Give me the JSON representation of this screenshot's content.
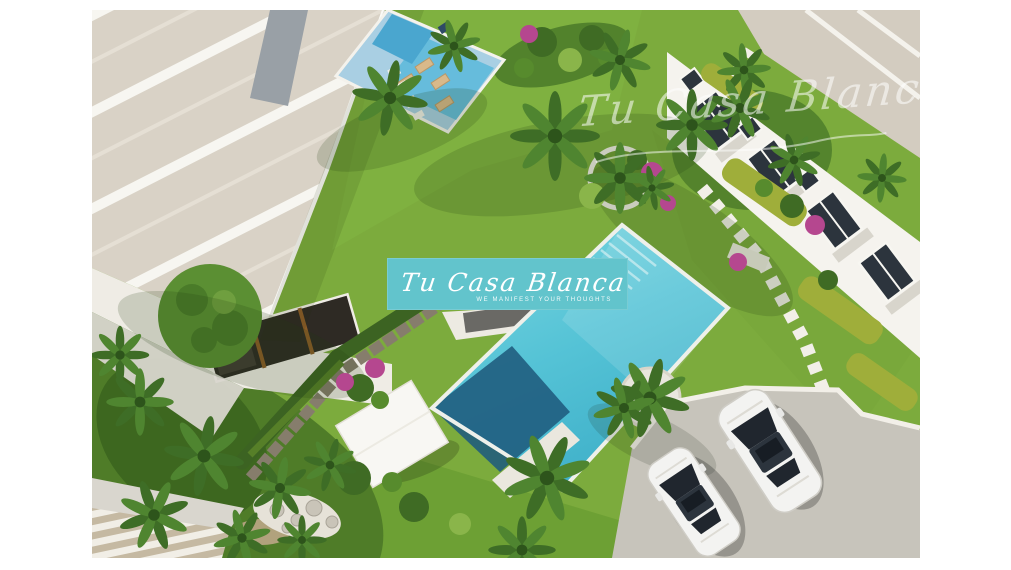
{
  "image": {
    "type": "3D architectural aerial render",
    "alt": "Aerial view of a white residential development with a large turquoise pool, a small lounge pool, landscaped palm gardens, townhouses and a parking area with two white cars"
  },
  "watermarks": {
    "center": {
      "brand": "Tu Casa Blanca",
      "tagline": "We manifest your thoughts"
    },
    "corner": {
      "brand": "Tu Casa Blanca"
    }
  },
  "colors": {
    "background": "#ffffff",
    "lawn": "#7cab3d",
    "lawn_dark": "#4f7c28",
    "pool_water": "#55c3d6",
    "pool_deep": "#1f5b7d",
    "small_pool_deck": "#a9cfe3",
    "roof_gravel": "#d9d2c6",
    "building_white": "#f5f3ee",
    "paving": "#d3ccc0",
    "parking": "#c7c4bb",
    "car_white": "#f3f3f1",
    "window_dark": "#2c343d",
    "watermark_teal": "#62c4cc",
    "flower_magenta": "#b5478f",
    "hedge_yellow_green": "#9fae3a",
    "palm_green": "#3e6d26",
    "stone_wall": "#867d6c"
  }
}
